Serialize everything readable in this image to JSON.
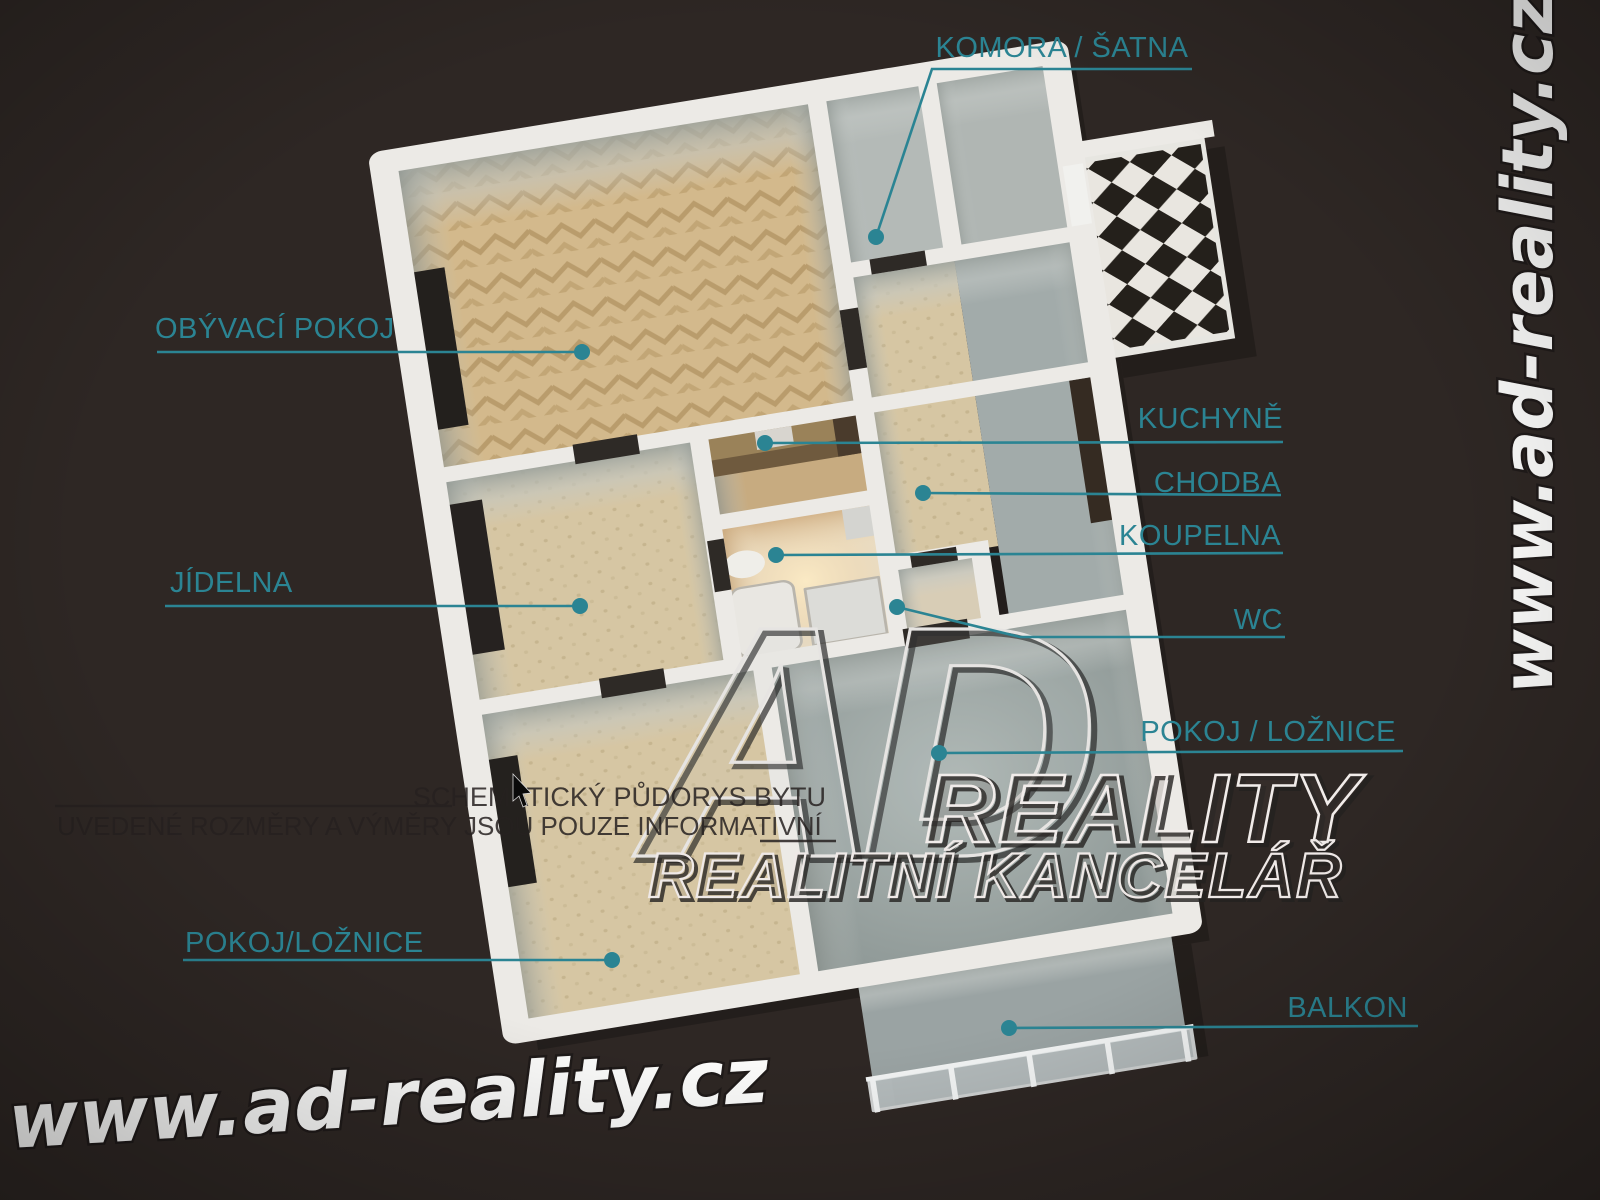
{
  "image_type": "3d-floor-plan-rendering",
  "plan_labels": [
    {
      "id": "komora-satna",
      "text": "KOMORA / ŠATNA",
      "anchor": "middle",
      "tx": 1062,
      "ty": 57,
      "line": [
        [
          1192,
          69
        ],
        [
          932,
          69
        ],
        [
          876,
          237
        ]
      ],
      "dot": [
        876,
        237
      ]
    },
    {
      "id": "obyvaci-pokoj",
      "text": "OBÝVACÍ POKOJ",
      "anchor": "start",
      "tx": 155,
      "ty": 338,
      "line": [
        [
          157,
          352
        ],
        [
          582,
          352
        ]
      ],
      "dot": [
        582,
        352
      ]
    },
    {
      "id": "kuchyne",
      "text": "KUCHYNĚ",
      "anchor": "end",
      "tx": 1283,
      "ty": 428,
      "line": [
        [
          1283,
          442
        ],
        [
          765,
          443
        ]
      ],
      "dot": [
        765,
        443
      ]
    },
    {
      "id": "chodba",
      "text": "CHODBA",
      "anchor": "end",
      "tx": 1281,
      "ty": 492,
      "line": [
        [
          1281,
          495
        ],
        [
          923,
          493
        ]
      ],
      "dot": [
        923,
        493
      ]
    },
    {
      "id": "koupelna",
      "text": "KOUPELNA",
      "anchor": "end",
      "tx": 1281,
      "ty": 545,
      "line": [
        [
          1283,
          553
        ],
        [
          776,
          555
        ]
      ],
      "dot": [
        776,
        555
      ]
    },
    {
      "id": "wc",
      "text": "WC",
      "anchor": "end",
      "tx": 1283,
      "ty": 629,
      "line": [
        [
          1285,
          637
        ],
        [
          1020,
          637
        ],
        [
          897,
          607
        ]
      ],
      "dot": [
        897,
        607
      ]
    },
    {
      "id": "pokoj-loznice-right",
      "text": "POKOJ / LOŽNICE",
      "anchor": "end",
      "tx": 1396,
      "ty": 741,
      "line": [
        [
          1403,
          751
        ],
        [
          939,
          753
        ]
      ],
      "dot": [
        939,
        753
      ]
    },
    {
      "id": "jidelna",
      "text": "JÍDELNA",
      "anchor": "start",
      "tx": 170,
      "ty": 592,
      "line": [
        [
          165,
          606
        ],
        [
          580,
          606
        ]
      ],
      "dot": [
        580,
        606
      ]
    },
    {
      "id": "pokoj-loznice-left",
      "text": "POKOJ/LOŽNICE",
      "anchor": "start",
      "tx": 185,
      "ty": 952,
      "line": [
        [
          183,
          960
        ],
        [
          612,
          960
        ]
      ],
      "dot": [
        612,
        960
      ]
    },
    {
      "id": "balkon",
      "text": "BALKON",
      "anchor": "end",
      "tx": 1408,
      "ty": 1017,
      "line": [
        [
          1418,
          1026
        ],
        [
          1009,
          1028
        ]
      ],
      "dot": [
        1009,
        1028
      ]
    }
  ],
  "disclaimer": {
    "line1": "SCHEMATICKÝ PŮDORYS BYTU",
    "line2": "UVEDENÉ ROZMĚRY A VÝMĚRY JSOU POUZE INFORMATIVNÍ"
  },
  "logo": {
    "monogram": "AD",
    "name": "REALITY",
    "tagline": "REALITNÍ KANCELÁŘ"
  },
  "watermarks": {
    "bottom_left": "www.ad-reality.cz",
    "right_vertical": "www.ad-reality.cz"
  },
  "colors": {
    "background": "#2e2724",
    "label_teal": "#2b8493",
    "wall_white": "#eceae6",
    "parquet": "#d3b98c",
    "carpet": "#d6c6a3",
    "floor_gray": "#8f9997",
    "bathroom_warm": "#e7dcc6",
    "checker_dark": "#24201b",
    "watermark_white": "#fbfbfa"
  }
}
